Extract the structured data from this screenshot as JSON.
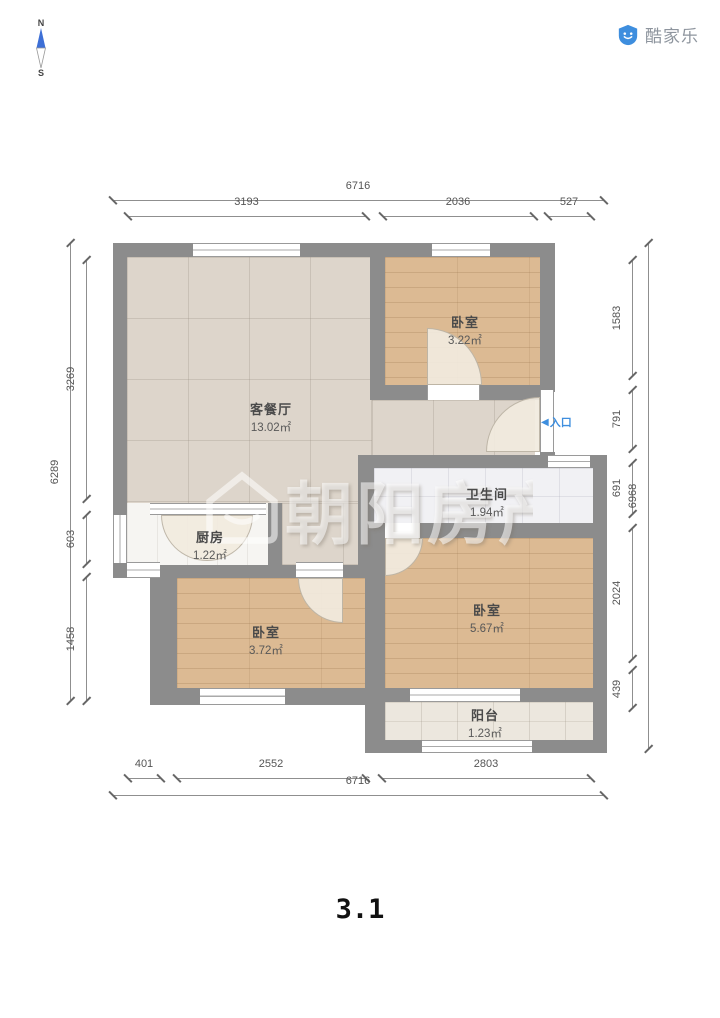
{
  "header": {
    "compass_north": "N",
    "compass_south": "S",
    "logo_text": "酷家乐"
  },
  "entrance": {
    "arrow": "◀",
    "label": "入口"
  },
  "watermark": {
    "text": "朝阳房产"
  },
  "scene_title": "3.1",
  "rooms": [
    {
      "id": "bedroom-top",
      "name": "卧室",
      "area": "3.22㎡",
      "cx": 465,
      "cy": 312
    },
    {
      "id": "living-dining",
      "name": "客餐厅",
      "area": "13.02㎡",
      "cx": 271,
      "cy": 399
    },
    {
      "id": "bathroom",
      "name": "卫生间",
      "area": "1.94㎡",
      "cx": 487,
      "cy": 484
    },
    {
      "id": "kitchen",
      "name": "厨房",
      "area": "1.22㎡",
      "cx": 210,
      "cy": 527
    },
    {
      "id": "bedroom-right",
      "name": "卧室",
      "area": "5.67㎡",
      "cx": 487,
      "cy": 600
    },
    {
      "id": "bedroom-left",
      "name": "卧室",
      "area": "3.72㎡",
      "cx": 266,
      "cy": 622
    },
    {
      "id": "balcony",
      "name": "阳台",
      "area": "1.23㎡",
      "cx": 485,
      "cy": 705
    }
  ],
  "dimensions": {
    "top": [
      {
        "label": "6716",
        "x1": 113,
        "x2": 603,
        "y": 200
      },
      {
        "label": "3193",
        "x1": 128,
        "x2": 365,
        "y": 216
      },
      {
        "label": "2036",
        "x1": 383,
        "x2": 533,
        "y": 216
      },
      {
        "label": "527",
        "x1": 548,
        "x2": 590,
        "y": 216
      }
    ],
    "bottom": [
      {
        "label": "401",
        "x1": 128,
        "x2": 160,
        "y": 778
      },
      {
        "label": "2552",
        "x1": 177,
        "x2": 365,
        "y": 778
      },
      {
        "label": "2803",
        "x1": 382,
        "x2": 590,
        "y": 778
      },
      {
        "label": "6716",
        "x1": 113,
        "x2": 603,
        "y": 795
      }
    ],
    "left": [
      {
        "label": "6289",
        "y1": 243,
        "y2": 700,
        "x": 70
      },
      {
        "label": "3269",
        "y1": 260,
        "y2": 498,
        "x": 86
      },
      {
        "label": "603",
        "y1": 515,
        "y2": 563,
        "x": 86
      },
      {
        "label": "1458",
        "y1": 577,
        "y2": 700,
        "x": 86
      }
    ],
    "right": [
      {
        "label": "1583",
        "y1": 260,
        "y2": 375,
        "x": 632
      },
      {
        "label": "791",
        "y1": 390,
        "y2": 448,
        "x": 632
      },
      {
        "label": "691",
        "y1": 463,
        "y2": 513,
        "x": 632
      },
      {
        "label": "2024",
        "y1": 528,
        "y2": 658,
        "x": 632
      },
      {
        "label": "439",
        "y1": 670,
        "y2": 707,
        "x": 632
      },
      {
        "label": "6968",
        "y1": 243,
        "y2": 748,
        "x": 648
      }
    ]
  },
  "colors": {
    "wall": "#8c8c8c",
    "accent_blue": "#3e8ede",
    "dim_text": "#555555",
    "wood": "#dcba93",
    "tile": "#ddd5cb"
  }
}
